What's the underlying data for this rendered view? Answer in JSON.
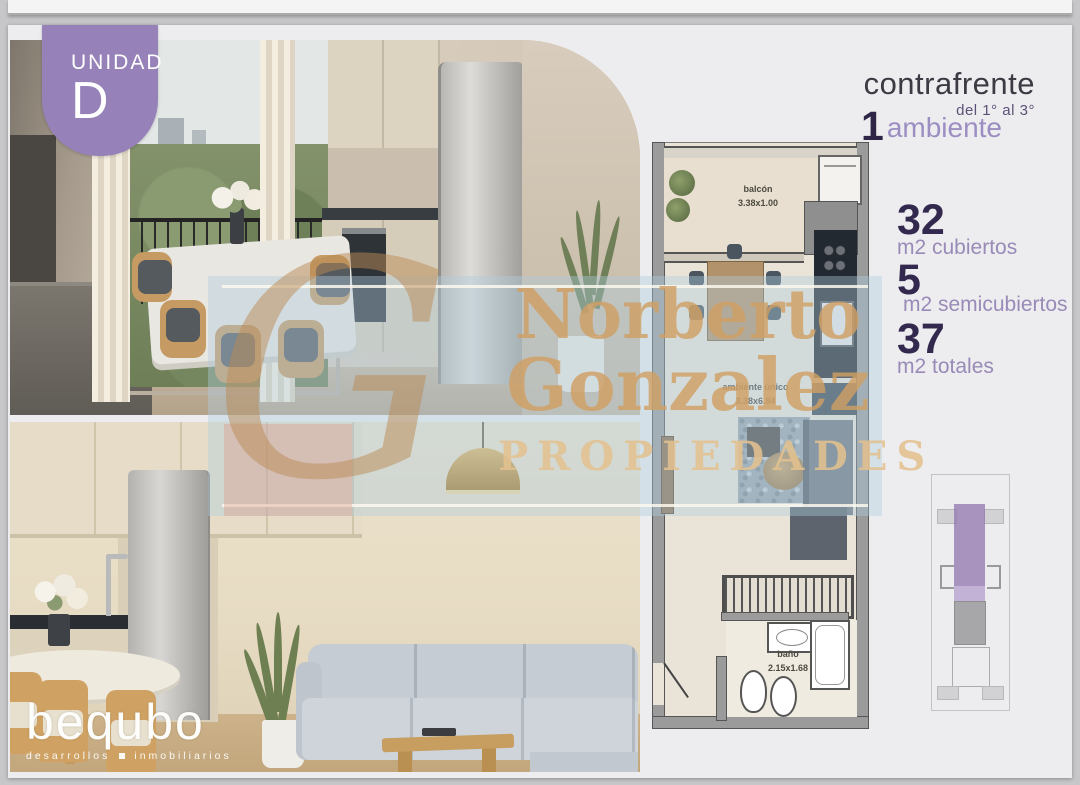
{
  "badge": {
    "label": "UNIDAD",
    "letter": "D"
  },
  "header": {
    "title": "contrafrente",
    "range": "del 1° al 3°",
    "rooms_value": "1",
    "rooms_label": "ambiente"
  },
  "metrics": [
    {
      "value": "32",
      "label": "m2 cubiertos"
    },
    {
      "value": "5",
      "label": "m2 semicubiertos"
    },
    {
      "value": "37",
      "label": "m2 totales"
    }
  ],
  "floorplan": {
    "rooms": [
      {
        "name": "balcón",
        "dims": "3.38x1.00"
      },
      {
        "name": "ambiente único",
        "dims": "3.38x6.84"
      },
      {
        "name": "baño",
        "dims": "2.15x1.68"
      }
    ]
  },
  "watermark": {
    "monogram": "G",
    "line1": "Norberto",
    "line2": "Gonzalez",
    "line3": "PROPIEDADES"
  },
  "brand": {
    "name": "bequbo",
    "tagline_left": "desarrollos",
    "tagline_right": "inmobiliarios"
  },
  "colors": {
    "accent_purple": "#9681b9",
    "dark_purple": "#33294e",
    "light_purple": "#998ab7",
    "title_gray": "#3d3a44",
    "watermark_tan": "#cf9f63",
    "watermark_band": "#afcddf",
    "slide_bg": "#ededef"
  }
}
